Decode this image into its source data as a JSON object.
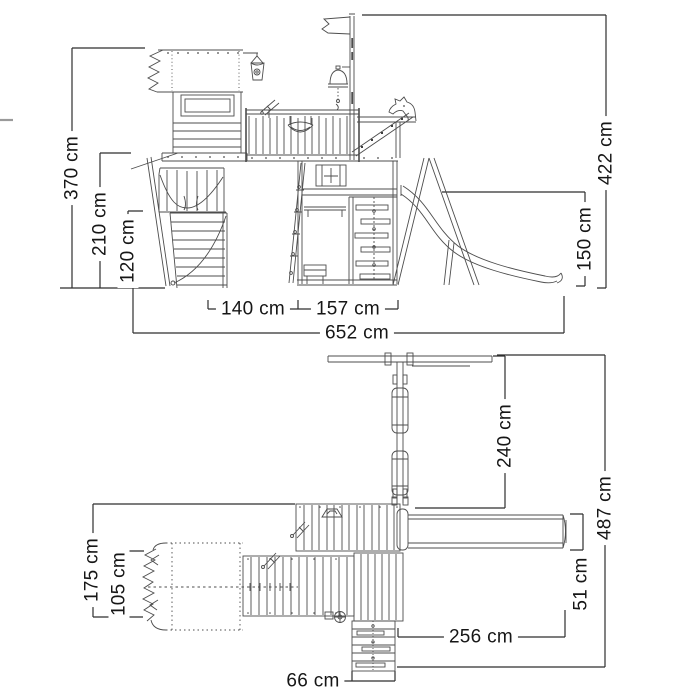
{
  "unit": "cm",
  "colors": {
    "background": "#ffffff",
    "drawing_line": "#4d4d4d",
    "dimension_line": "#2e2e2e",
    "text": "#161616"
  },
  "side_view": {
    "dimensions": {
      "total_height": "370 cm",
      "walkway_height": "210 cm",
      "climb_wall_height": "120 cm",
      "section_width_left": "140 cm",
      "section_width_right": "157 cm",
      "total_length": "652 cm",
      "overall_height_right": "422 cm",
      "platform_height": "150 cm"
    }
  },
  "plan_view": {
    "dimensions": {
      "left_depth": "175 cm",
      "tunnel_width": "105 cm",
      "swing_depth": "240 cm",
      "total_depth": "487 cm",
      "slide_width": "51 cm",
      "slide_length": "256 cm",
      "stairs_width": "66 cm"
    }
  }
}
